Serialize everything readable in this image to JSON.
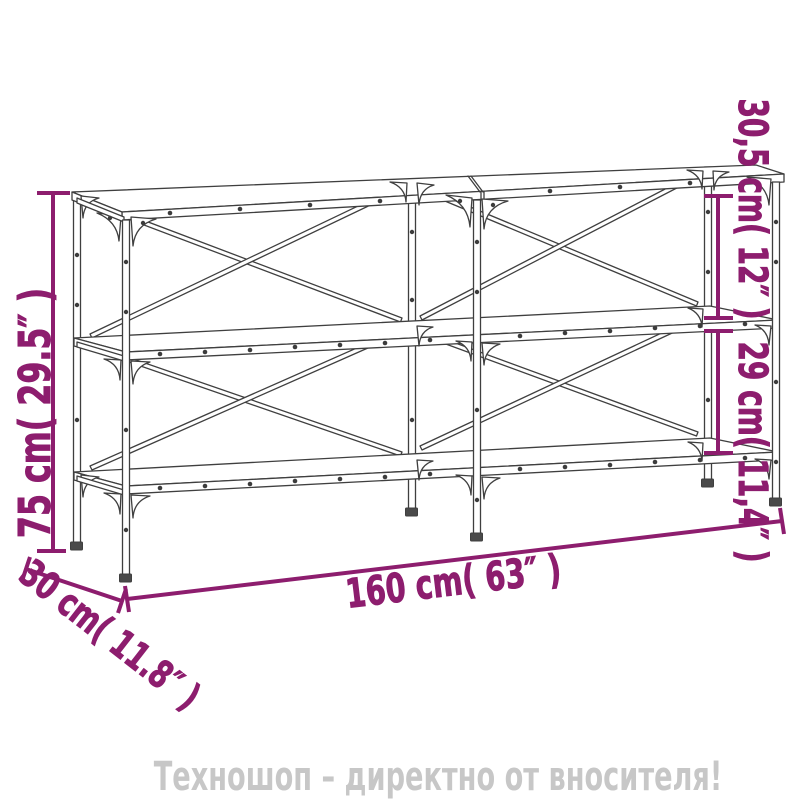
{
  "diagram": {
    "type": "furniture-dimension-diagram",
    "product": "console-table-two-shelves-x-frame",
    "dimension_color": "#8d1d6e",
    "drawing_color": "#3f3f3f",
    "labels": {
      "height": "75 cm( 29.5″ )",
      "top_section": "30,5 cm( 12″ )",
      "bottom_section": "29 cm( 11,4″ )",
      "length": "160 cm( 63″ )",
      "depth": "30 cm( 11.8″ )"
    }
  },
  "banner": {
    "text": "Техношоп – директно от вносителя!",
    "color": "#c7c7c7"
  }
}
